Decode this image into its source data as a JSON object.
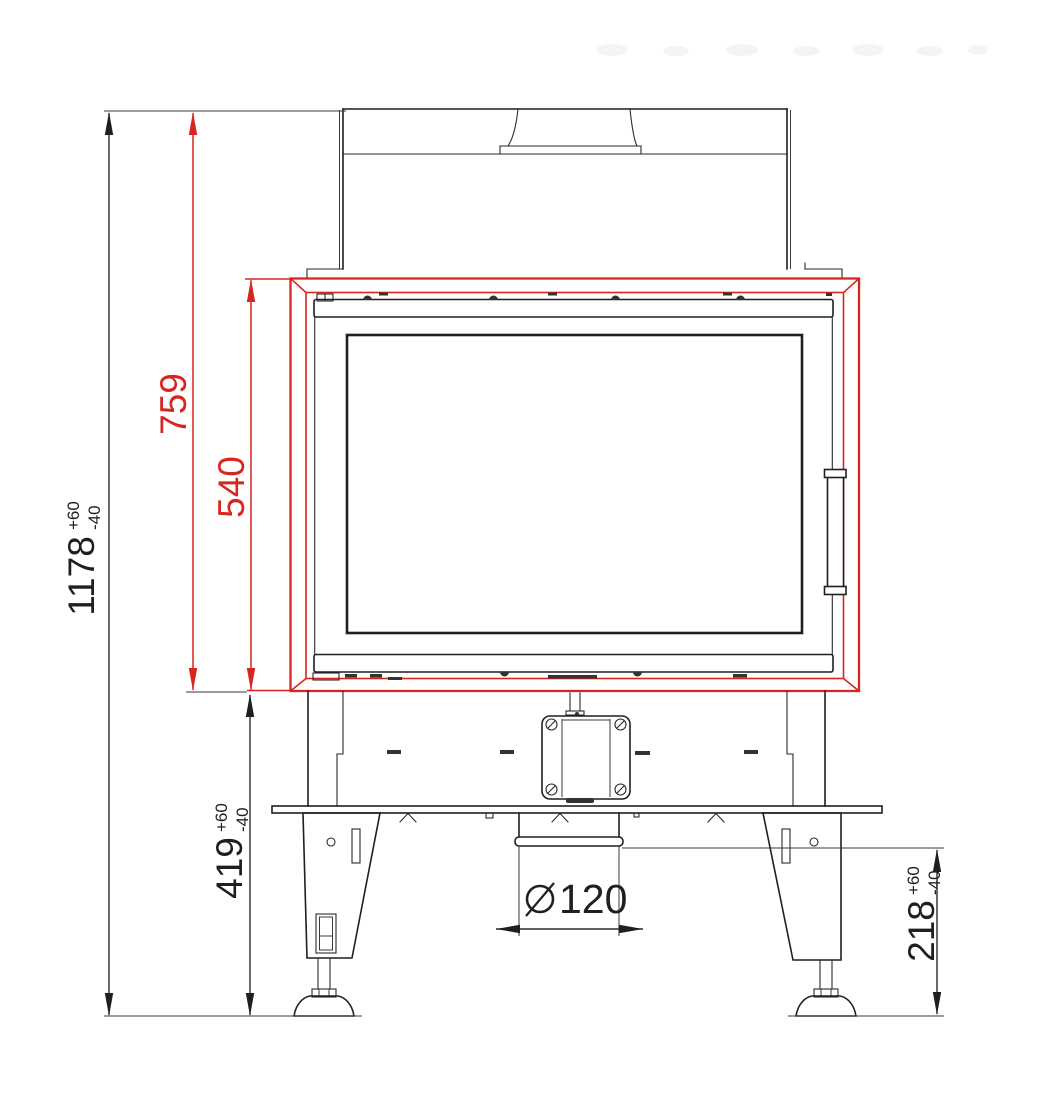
{
  "drawing": {
    "kind": "technical-dimension-drawing",
    "view": "front-elevation",
    "subject": "fireplace-insert",
    "units": "mm",
    "accent_color": "#d7261d",
    "line_color": "#1f1f1f"
  },
  "dims": {
    "total_height": {
      "value": "1178",
      "tol_plus": "+60",
      "tol_minus": "-40"
    },
    "body_top_height": {
      "value": "759"
    },
    "door_frame_height": {
      "value": "540"
    },
    "base_section_height": {
      "value": "419",
      "tol_plus": "+60",
      "tol_minus": "-40"
    },
    "legs_section_height": {
      "value": "218",
      "tol_plus": "+60",
      "tol_minus": "-40"
    },
    "flue_diameter": {
      "symbol": "⌀",
      "value": "120"
    }
  }
}
